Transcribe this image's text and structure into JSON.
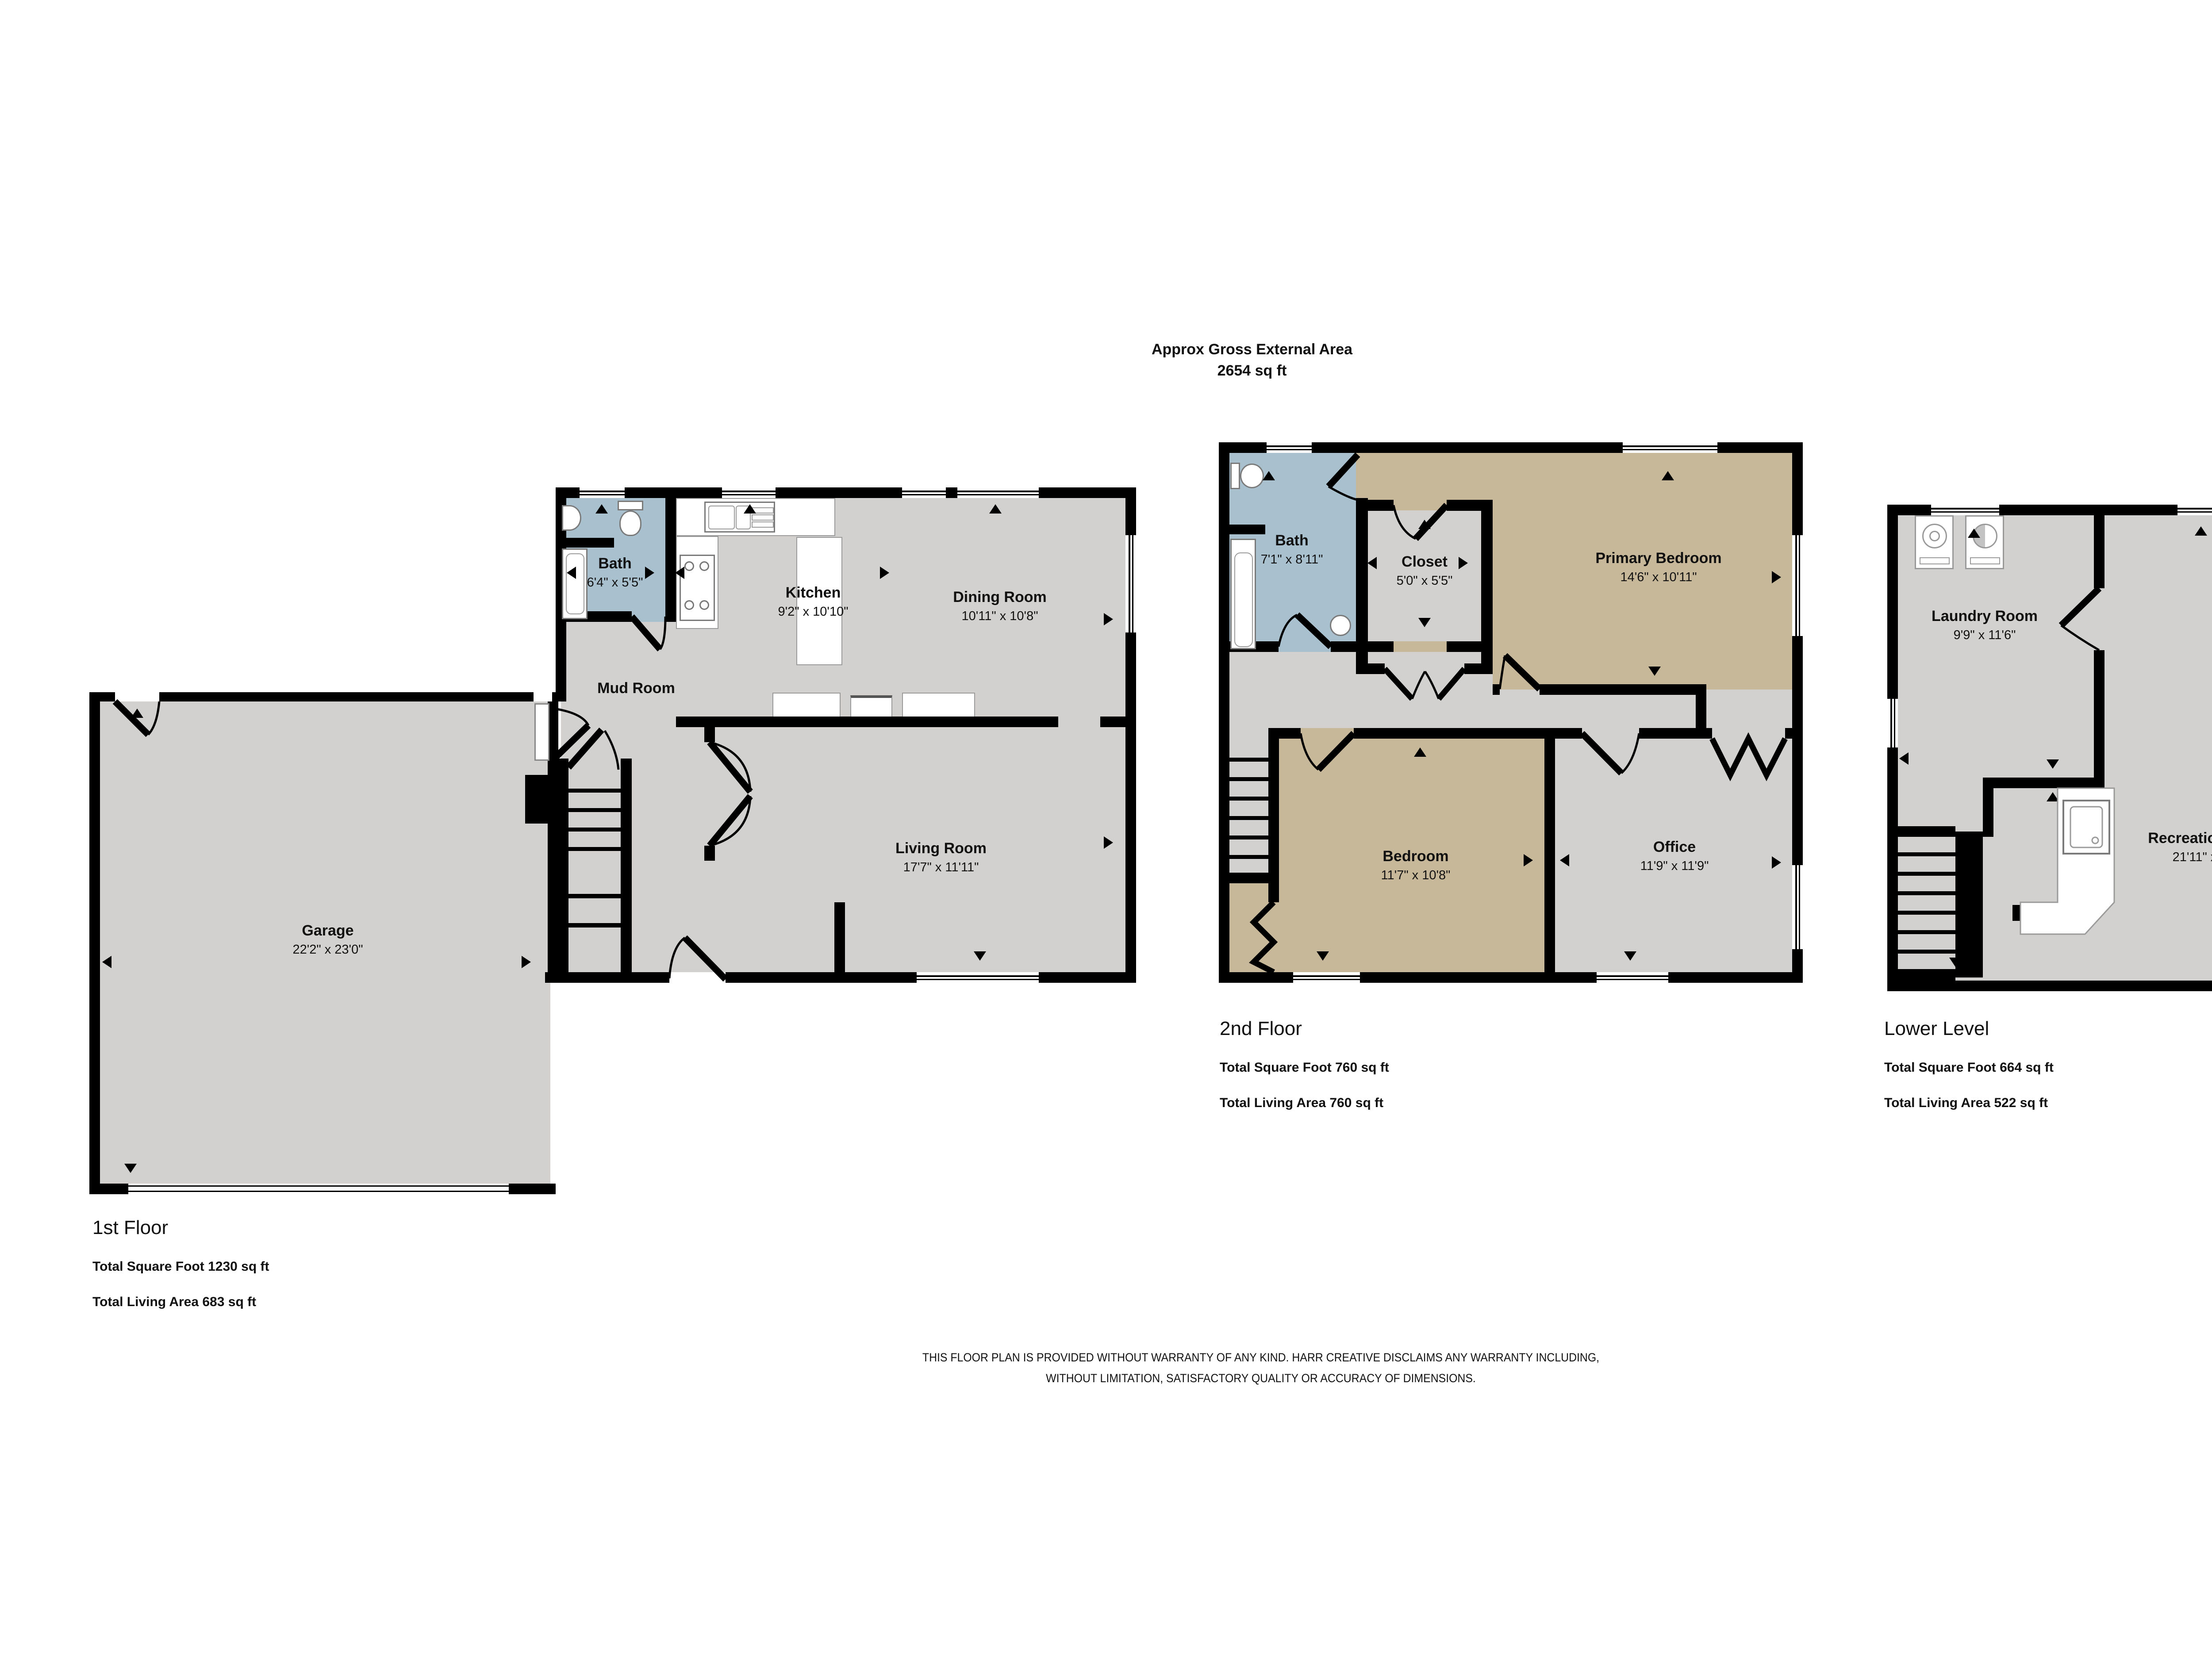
{
  "header": {
    "line1": "Approx Gross External Area",
    "line2": "2654 sq ft"
  },
  "floors": [
    {
      "title": "1st Floor",
      "total_square_foot": "Total Square Foot 1230 sq ft",
      "total_living_area": "Total Living Area 683 sq ft",
      "rooms": [
        {
          "name": "Garage",
          "dims": "22'2\" x 23'0\""
        },
        {
          "name": "Bath",
          "dims": "6'4\" x 5'5\""
        },
        {
          "name": "Kitchen",
          "dims": "9'2\" x 10'10\""
        },
        {
          "name": "Dining Room",
          "dims": "10'11\" x 10'8\""
        },
        {
          "name": "Mud Room",
          "dims": ""
        },
        {
          "name": "Living Room",
          "dims": "17'7\" x 11'11\""
        }
      ]
    },
    {
      "title": "2nd Floor",
      "total_square_foot": "Total Square Foot 760 sq ft",
      "total_living_area": "Total Living Area 760 sq ft",
      "rooms": [
        {
          "name": "Bath",
          "dims": "7'1\" x 8'11\""
        },
        {
          "name": "Closet",
          "dims": "5'0\" x 5'5\""
        },
        {
          "name": "Primary Bedroom",
          "dims": "14'6\" x 10'11\""
        },
        {
          "name": "Bedroom",
          "dims": "11'7\" x 10'8\""
        },
        {
          "name": "Office",
          "dims": "11'9\" x 11'9\""
        }
      ]
    },
    {
      "title": "Lower Level",
      "total_square_foot": "Total Square Foot 664 sq ft",
      "total_living_area": "Total Living Area 522 sq ft",
      "rooms": [
        {
          "name": "Laundry Room",
          "dims": "9'9\" x 11'6\""
        },
        {
          "name": "Recreation Room",
          "dims": "16'8\" x 11'2\""
        },
        {
          "name": "Recreation Room",
          "dims": "21'11\" x 11'2\""
        }
      ]
    }
  ],
  "disclaimer": {
    "line1": "THIS FLOOR PLAN IS PROVIDED WITHOUT WARRANTY OF ANY KIND. HARR CREATIVE DISCLAIMS ANY WARRANTY INCLUDING,",
    "line2": "WITHOUT LIMITATION, SATISFACTORY QUALITY OR ACCURACY OF DIMENSIONS."
  },
  "colors": {
    "wall": "#000000",
    "room_gray": "#d2d1cf",
    "bath_blue": "#a9c0ce",
    "bedroom_tan": "#c8b89a",
    "background": "#ffffff"
  }
}
